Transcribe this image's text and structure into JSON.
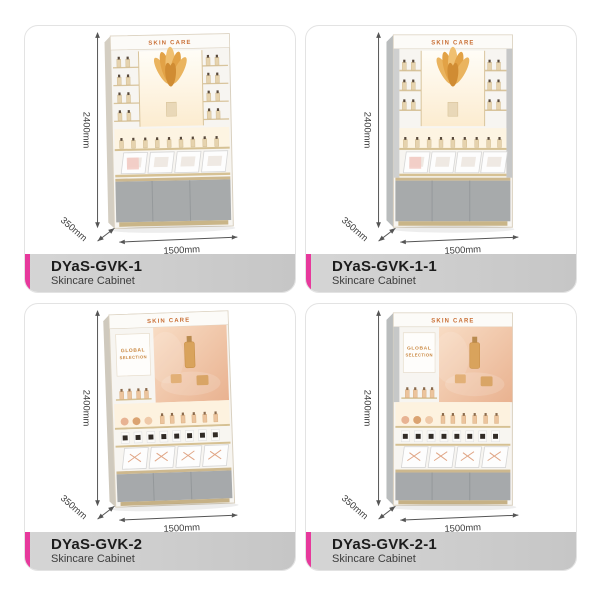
{
  "accent_color": "#e7399c",
  "cards": [
    {
      "model": "DYaS-GVK-1",
      "category": "Skincare Cabinet",
      "cabinet": {
        "header_text": "SKIN CARE",
        "style": "gold feather display, open glass side shelves, grey 3-door base"
      },
      "dimensions": {
        "height": "2400mm",
        "depth": "350mm",
        "width": "1500mm"
      }
    },
    {
      "model": "DYaS-GVK-1-1",
      "category": "Skincare Cabinet",
      "cabinet": {
        "header_text": "SKIN CARE",
        "style": "gold feather display, solid grey side panels, grey 3-door base"
      },
      "dimensions": {
        "height": "2400mm",
        "depth": "350mm",
        "width": "1500mm"
      }
    },
    {
      "model": "DYaS-GVK-2",
      "category": "Skincare Cabinet",
      "cabinet": {
        "header_text": "SKIN CARE",
        "sign_line1": "GLOBAL",
        "sign_line2": "SELECTION",
        "style": "peach poster display with global selection sign, grey 3-door base"
      },
      "dimensions": {
        "height": "2400mm",
        "depth": "350mm",
        "width": "1500mm"
      }
    },
    {
      "model": "DYaS-GVK-2-1",
      "category": "Skincare Cabinet",
      "cabinet": {
        "header_text": "SKIN CARE",
        "sign_line1": "GLOBAL",
        "sign_line2": "SELECTION",
        "style": "peach poster display with global selection sign, grey 3-door base"
      },
      "dimensions": {
        "height": "2400mm",
        "depth": "350mm",
        "width": "1500mm"
      }
    }
  ]
}
